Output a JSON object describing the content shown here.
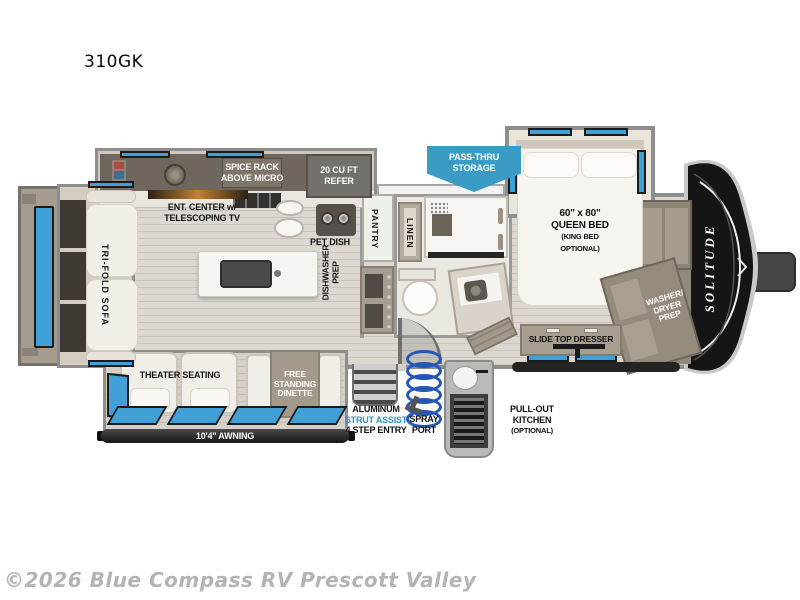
{
  "page": {
    "title": "310GK",
    "watermark": "©2026 Blue Compass RV Prescott Valley"
  },
  "floorplan": {
    "model": "310GK",
    "brand_logo": "SOLITUDE",
    "labels": {
      "tri_fold_sofa": "TRI-FOLD SOFA",
      "theater_seating": "THEATER SEATING",
      "free_standing_dinette": {
        "l1": "FREE",
        "l2": "STANDING",
        "l3": "DINETTE"
      },
      "ent_center": {
        "l1": "ENT. CENTER w/",
        "l2": "TELESCOPING TV"
      },
      "spice_rack": {
        "l1": "SPICE RACK",
        "l2": "ABOVE MICRO"
      },
      "refer": {
        "l1": "20 CU FT",
        "l2": "REFER"
      },
      "pet_dish": "PET DISH",
      "dishwasher_prep": {
        "l1": "DISHWASHER",
        "l2": "PREP"
      },
      "pantry": "PANTRY",
      "linen": "LINEN",
      "pass_thru_storage": {
        "l1": "PASS-THRU",
        "l2": "STORAGE"
      },
      "queen_bed": {
        "l1": "60\" x 80\"",
        "l2": "QUEEN BED",
        "l3": "(KING BED",
        "l4": "OPTIONAL)"
      },
      "washer_dryer_prep": {
        "l1": "WASHER/",
        "l2": "DRYER",
        "l3": "PREP"
      },
      "slide_top_dresser": "SLIDE TOP DRESSER",
      "step_entry": {
        "l1": "ALUMINUM",
        "l2": "STRUT ASSIST",
        "l3": "4 STEP ENTRY"
      },
      "spray_port": {
        "l1": "SPRAY",
        "l2": "PORT"
      },
      "pull_out_kitchen": {
        "l1": "PULL-OUT",
        "l2": "KITCHEN",
        "l3": "(OPTIONAL)"
      },
      "awning": "10'4\" AWNING"
    },
    "colors": {
      "window_blue": "#41a0d5",
      "banner_blue": "#3a9cc4",
      "strut_text_blue": "#2e93c8",
      "cap_black": "#151515"
    }
  }
}
